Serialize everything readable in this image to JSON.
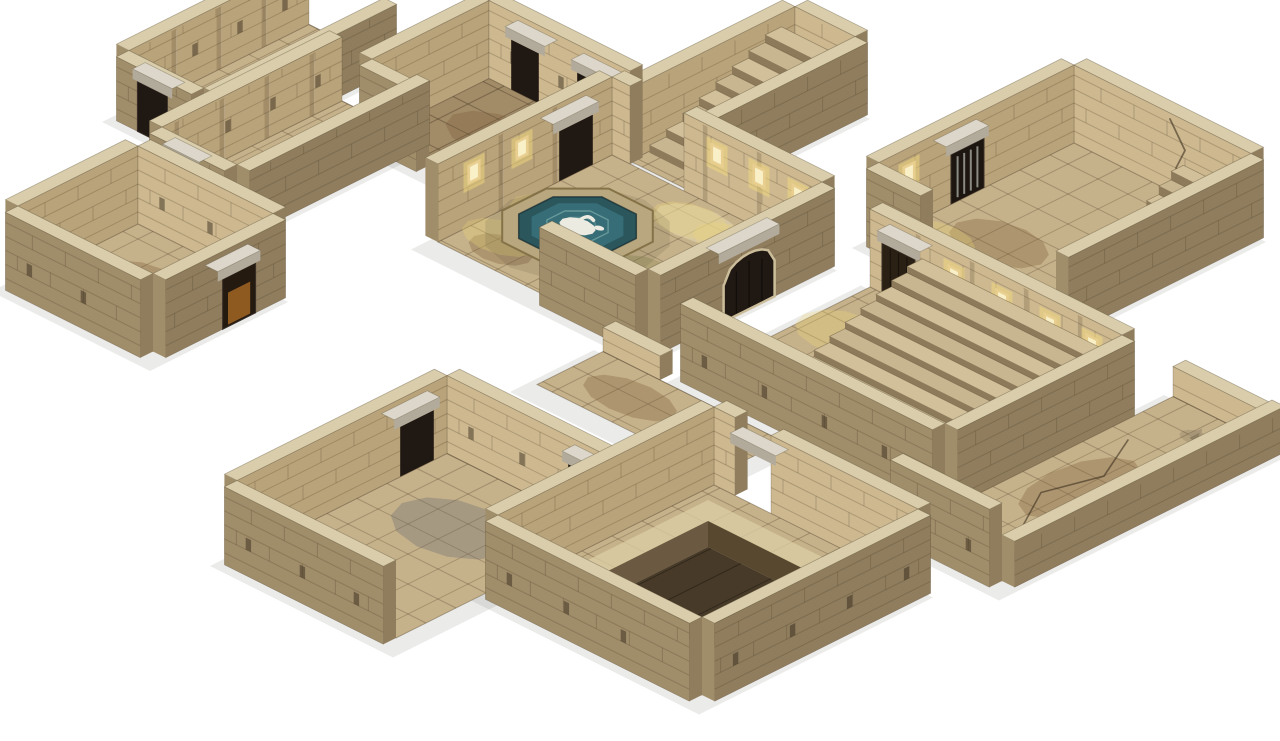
{
  "scene": {
    "title": "Isometric 3D render of a modular stone dungeon tileset on a white background",
    "background": "#ffffff",
    "projection": {
      "ox": 648,
      "oy": 14,
      "tx": 30,
      "ty": 15,
      "th": 0.42,
      "wallH": 78
    },
    "palette": {
      "floorTan": "#c6b28a",
      "floorDark": "#a28b67",
      "gridLine": "rgba(70,52,30,0.28)",
      "gridDark": "rgba(48,36,20,0.35)",
      "intNE": "#cdb88f",
      "intNW": "#b9a37a",
      "extSE": "#8f7d5e",
      "extSW": "#a08d6a",
      "top": "#d9cdab",
      "brick": "rgba(75,58,36,0.25)",
      "pilaster": "rgba(70,55,35,0.20)",
      "pilEdge": "rgba(255,255,255,0.12)",
      "hole": "rgba(45,34,20,0.45)",
      "lintel": "#dcd7ca",
      "lintelSide": "#b2ab9b",
      "doorDark": "#2b2014",
      "openDark": "#201812",
      "barMetal": "#8a8a82",
      "doorGlow": "rgba(214,134,44,0.60)",
      "rim": "#b9a87f",
      "rimStroke": "#857248",
      "water": "#2a565c",
      "waterMid": "#39707a",
      "ripple": "#7fb0ad",
      "statueWhite": "#ecebe2",
      "stepTop": "#d2c09a",
      "stepTopAlt": "#c8b690",
      "stepRise": "#8d7a5b",
      "pitSideA": "#6b5941",
      "pitSideB": "#57482f",
      "pitFloor": "#473a28",
      "pitRing": "#dcceA6",
      "grate": "#1d1914",
      "grateBar": "#675f50",
      "grateFrame": "#3c352a",
      "sconceCore": "#faf0c8",
      "sconceMid": "#e9cf8f",
      "sconceGlow": "rgba(248,222,126,0.45)",
      "glowPool": "rgba(240,214,120,0.30)",
      "stainBrown": "rgba(120,90,55,0.32)",
      "stainGreen": "rgba(125,125,70,0.30)",
      "stainGray": "rgba(105,105,110,0.34)",
      "stainLight": "rgba(238,228,198,0.40)",
      "crack": "rgba(50,38,24,0.55)",
      "shadow": "rgba(60,55,45,0.10)",
      "statueStone": "#b0a284",
      "statueStoneDark": "#92855f"
    },
    "modules": [
      {
        "name": "north-stair-corridor",
        "rect": [
          4.6,
          -0.3,
          6.6,
          5.2
        ],
        "floor": "floorTan",
        "walls": [
          {
            "side": "NW",
            "h": 72,
            "segs": [
              [
                -0.3,
                5.2
              ]
            ]
          },
          {
            "side": "NE",
            "h": 72,
            "segs": [
              [
                4.6,
                6.6
              ]
            ]
          },
          {
            "side": "SE",
            "h": 72,
            "segs": [
              [
                -0.3,
                5.2
              ]
            ]
          }
        ],
        "stairs": [
          {
            "i0": 4.65,
            "j0": 0.2,
            "i1": 6.55,
            "j1": 4.6,
            "n": 8,
            "top": 60
          }
        ]
      },
      {
        "name": "northwest-hall",
        "rect": [
          -0.5,
          4.8,
          4.2,
          8.7
        ],
        "floor": "floorDark",
        "walls": [
          {
            "side": "NW",
            "h": 78,
            "segs": [
              [
                4.8,
                8.7
              ]
            ]
          },
          {
            "side": "NE",
            "h": 78,
            "segs": [
              [
                -0.5,
                4.2
              ]
            ],
            "lintelGaps": [
              [
                0.2,
                1.2
              ],
              [
                2.4,
                3.4
              ]
            ],
            "holes": 1.6
          },
          {
            "side": "SW",
            "h": 78,
            "segs": [
              [
                -0.5,
                1.4
              ]
            ]
          }
        ],
        "stains": [
          {
            "c": [
              1.6,
              6.6
            ],
            "r": [
              1.5,
              0.9
            ],
            "color": "stainBrown"
          }
        ]
      },
      {
        "name": "west-upper-corridor",
        "rect": [
          -5.3,
          6,
          -2.8,
          12
        ],
        "floor": "floorTan",
        "walls": [
          {
            "side": "NW",
            "h": 64,
            "segs": [
              [
                6,
                12
              ]
            ],
            "pil": 1.5,
            "holes": 1.5
          },
          {
            "side": "SE",
            "h": 64,
            "segs": [
              [
                6,
                12
              ]
            ]
          },
          {
            "side": "SW",
            "h": 64,
            "segs": [
              [
                -5.3,
                -2.8
              ]
            ],
            "doors": [
              {
                "a": -4.6,
                "b": -3.6,
                "type": "open",
                "lintel": true
              }
            ]
          }
        ],
        "stains": [
          {
            "c": [
              -4.0,
              9.0
            ],
            "r": [
              0.8,
              1.8
            ],
            "color": "stainBrown"
          }
        ]
      },
      {
        "name": "west-lower-corridor",
        "rect": [
          -2.2,
          8,
          0.3,
          14
        ],
        "floor": "floorTan",
        "walls": [
          {
            "side": "NW",
            "h": 64,
            "segs": [
              [
                8,
                14
              ]
            ],
            "pil": 1.5,
            "holes": 1.5
          },
          {
            "side": "SE",
            "h": 64,
            "segs": [
              [
                8,
                14
              ]
            ]
          },
          {
            "side": "SW",
            "h": 64,
            "segs": [
              [
                -2.2,
                0.3
              ]
            ],
            "doors": [
              {
                "a": -1.6,
                "b": -0.7,
                "type": "open",
                "lintel": true
              }
            ]
          }
        ],
        "stains": [
          {
            "c": [
              -0.9,
              11.0
            ],
            "r": [
              0.7,
              1.7
            ],
            "color": "stainBrown"
          }
        ]
      },
      {
        "name": "far-right-room",
        "rect": [
          11.4,
          -2.8,
          17.3,
          3.7
        ],
        "floor": "floorTan",
        "walls": [
          {
            "side": "NE",
            "h": 78,
            "segs": [
              [
                11.4,
                17.3
              ]
            ],
            "crack": [
              [
                14.6,
                72
              ],
              [
                15.1,
                48
              ],
              [
                14.8,
                26
              ],
              [
                15.6,
                4
              ]
            ]
          },
          {
            "side": "NW",
            "h": 78,
            "segs": [
              [
                -2.8,
                3.7
              ]
            ],
            "doors": [
              {
                "a": 0.2,
                "b": 1.3,
                "type": "barred",
                "lintel": true
              }
            ],
            "sconces": [
              2.7
            ]
          },
          {
            "side": "SE",
            "h": 78,
            "segs": [
              [
                -2.8,
                3.7
              ]
            ]
          },
          {
            "side": "SW",
            "h": 78,
            "segs": [
              [
                11.4,
                13.2
              ]
            ]
          },
          {
            "side": "SW",
            "h": 34,
            "segs": [
              [
                15.4,
                17.3
              ]
            ]
          }
        ],
        "stairs": [
          {
            "i0": 15.1,
            "j0": -2.75,
            "i1": 17.25,
            "j1": -1.1,
            "n": 4,
            "top": 34
          }
        ],
        "stains": [
          {
            "c": [
              13.5,
              1.8
            ],
            "r": [
              1.4,
              0.9
            ],
            "color": "stainBrown"
          }
        ]
      },
      {
        "name": "fountain-hall",
        "rect": [
          4.1,
          5.3,
          11.1,
          11.1
        ],
        "floor": "floorTan",
        "walls": [
          {
            "side": "NE",
            "h": 78,
            "segs": [
              [
                4.1,
                4.7
              ],
              [
                6.5,
                11.1
              ]
            ],
            "sconces": [
              7.6,
              9.0,
              10.3
            ],
            "pil": 1.8
          },
          {
            "side": "NW",
            "h": 78,
            "segs": [
              [
                5.3,
                11.1
              ]
            ],
            "lintelGaps": [
              [
                5.9,
                7.1
              ]
            ],
            "sconces": [
              8.3,
              9.9
            ],
            "pil": 1.8
          },
          {
            "side": "SE",
            "h": 78,
            "segs": [
              [
                5.3,
                11.1
              ]
            ],
            "doors": [
              {
                "a": 7.3,
                "b": 9.0,
                "type": "arch",
                "lintel": true
              }
            ]
          },
          {
            "side": "SW",
            "h": 78,
            "segs": [
              [
                7.9,
                11.1
              ]
            ]
          }
        ],
        "fountain": {
          "c": [
            5.9,
            8.25
          ],
          "r": 1.5
        },
        "stains": [
          {
            "c": [
              8.8,
              9.0
            ],
            "r": [
              1.5,
              1.0
            ],
            "color": "stainGreen"
          },
          {
            "c": [
              9.6,
              6.6
            ],
            "r": [
              1.1,
              0.7
            ],
            "color": "stainBrown"
          },
          {
            "c": [
              5.4,
              10.3
            ],
            "r": [
              0.9,
              0.6
            ],
            "color": "stainBrown"
          },
          {
            "c": [
              7.8,
              6.2
            ],
            "r": [
              1.2,
              0.7
            ],
            "color": "stainLight"
          }
        ]
      },
      {
        "name": "left-arc-room",
        "rect": [
          -1.5,
          15.5,
          3,
          19.5
        ],
        "floor": "floorTan",
        "walls": [
          {
            "side": "NW",
            "h": 78,
            "segs": [
              [
                15.5,
                19.5
              ]
            ]
          },
          {
            "side": "NE",
            "h": 78,
            "segs": [
              [
                -1.5,
                3
              ]
            ],
            "holes": 1.6
          },
          {
            "side": "SE",
            "h": 78,
            "segs": [
              [
                15.5,
                19.5
              ]
            ],
            "doors": [
              {
                "a": 16.5,
                "b": 17.6,
                "type": "glow",
                "lintel": true
              }
            ]
          },
          {
            "side": "SW",
            "h": 78,
            "segs": [
              [
                -1.5,
                3
              ]
            ],
            "holes": 1.8
          }
        ],
        "arcs": {
          "c": [
            2.4,
            17.4
          ],
          "radii": [
            0.7,
            1.2,
            1.7
          ]
        },
        "stains": [
          {
            "c": [
              0.4,
              17.4
            ],
            "r": [
              1.1,
              0.8
            ],
            "color": "stainBrown"
          }
        ]
      },
      {
        "name": "grand-stair-room",
        "rect": [
          12.8,
          5.4,
          21.2,
          11.3
        ],
        "floor": "floorTan",
        "walls": [
          {
            "side": "NE",
            "h": 78,
            "segs": [
              [
                12.8,
                21.2
              ]
            ],
            "doors": [
              {
                "a": 13.2,
                "b": 14.3,
                "type": "wood",
                "lintel": true
              }
            ],
            "sconces": [
              15.6,
              17.2,
              18.8,
              20.2
            ],
            "pil": 1.8
          },
          {
            "side": "SE",
            "h": 78,
            "segs": [
              [
                5.4,
                11.3
              ]
            ]
          },
          {
            "side": "SW",
            "h": 78,
            "segs": [
              [
                12.8,
                21.2
              ]
            ],
            "holes": 2.0
          }
        ],
        "stairs": [
          {
            "i0": 14.6,
            "j0": 5.45,
            "i1": 20.9,
            "j1": 10.1,
            "n": 9,
            "top": 56
          }
        ],
        "statues": [
          [
            13.6,
            10.0
          ]
        ],
        "stains": [
          {
            "c": [
              13.8,
              7.4
            ],
            "r": [
              1.2,
              0.9
            ],
            "color": "glowPool"
          },
          {
            "c": [
              16.2,
              10.6
            ],
            "r": [
              1.3,
              0.8
            ],
            "color": "stainBrown"
          },
          {
            "c": [
              20.2,
              10.8
            ],
            "r": [
              0.9,
              0.6
            ],
            "color": "stainGreen"
          }
        ]
      },
      {
        "name": "center-passage",
        "rect": [
          10.5,
          12,
          16.5,
          14.2
        ],
        "floor": "floorTan",
        "walls": [
          {
            "side": "NE",
            "h": 24,
            "segs": [
              [
                10.5,
                12.4
              ]
            ]
          }
        ],
        "stains": [
          {
            "c": [
              12.5,
              13.1
            ],
            "r": [
              1.4,
              0.7
            ],
            "color": "stainBrown"
          }
        ]
      },
      {
        "name": "bottom-right-gallery",
        "rect": [
          21.5,
          4,
          24.8,
          13
        ],
        "floor": "floorTan",
        "walls": [
          {
            "side": "NE",
            "h": 30,
            "segs": [
              [
                21.5,
                24.8
              ]
            ]
          },
          {
            "side": "SE",
            "h": 46,
            "segs": [
              [
                4,
                13
              ]
            ]
          },
          {
            "side": "SW",
            "h": 78,
            "segs": [
              [
                21.5,
                24.8
              ]
            ],
            "holes": 1.8
          }
        ],
        "floorCracks": [
          [
            [
              22.2,
              6.2
            ],
            [
              23.0,
              7.8
            ],
            [
              22.5,
              9.4
            ],
            [
              23.3,
              10.8
            ]
          ]
        ],
        "rubble": [
          [
            24.0,
            12.1
          ],
          [
            22.1,
            12.4
          ],
          [
            23.2,
            5.0
          ]
        ],
        "stains": [
          {
            "c": [
              23.0,
              8.6
            ],
            "r": [
              1.0,
              1.8
            ],
            "color": "stainBrown"
          }
        ]
      },
      {
        "name": "bottom-left-room",
        "rect": [
          11.3,
          18,
          16.6,
          25
        ],
        "floor": "floorTan",
        "walls": [
          {
            "side": "NE",
            "h": 78,
            "segs": [
              [
                11.3,
                16.6
              ]
            ],
            "lintelGaps": [
              [
                15.3,
                16.4
              ]
            ],
            "holes": 1.7
          },
          {
            "side": "NW",
            "h": 78,
            "segs": [
              [
                18,
                25
              ]
            ],
            "lintelGaps": [
              [
                18.4,
                19.6
              ]
            ]
          },
          {
            "side": "SW",
            "h": 78,
            "segs": [
              [
                11.3,
                16.6
              ]
            ],
            "holes": 1.8
          }
        ],
        "stains": [
          {
            "c": [
              13.9,
              20.4
            ],
            "r": [
              1.7,
              1.2
            ],
            "color": "stainGray"
          },
          {
            "c": [
              12.6,
              23.2
            ],
            "r": [
              1.1,
              0.8
            ],
            "color": "stainBrown"
          }
        ]
      },
      {
        "name": "pit-room",
        "rect": [
          16.8,
          14.6,
          23.6,
          21.8
        ],
        "floor": "floorTan",
        "walls": [
          {
            "side": "NE",
            "h": 78,
            "segs": [
              [
                16.8,
                17.5
              ],
              [
                18.7,
                23.6
              ]
            ],
            "bridges": [
              {
                "a": 17.5,
                "b": 18.7
              }
            ]
          },
          {
            "side": "NW",
            "h": 78,
            "segs": [
              [
                14.6,
                21.8
              ]
            ]
          },
          {
            "side": "SE",
            "h": 78,
            "segs": [
              [
                14.6,
                21.8
              ]
            ],
            "holes": 1.9
          },
          {
            "side": "SW",
            "h": 78,
            "segs": [
              [
                16.8,
                23.6
              ]
            ],
            "holes": 1.9
          }
        ],
        "pit": {
          "i0": 17.9,
          "j0": 15.9,
          "i1": 21.3,
          "j1": 19.3,
          "d": 26,
          "ring": 0.7
        },
        "grate": {
          "i": 21.55,
          "j": 18.45,
          "s": 0.85
        },
        "stains": [
          {
            "c": [
              18.0,
              20.6
            ],
            "r": [
              1.0,
              0.7
            ],
            "color": "stainBrown"
          }
        ]
      }
    ]
  }
}
